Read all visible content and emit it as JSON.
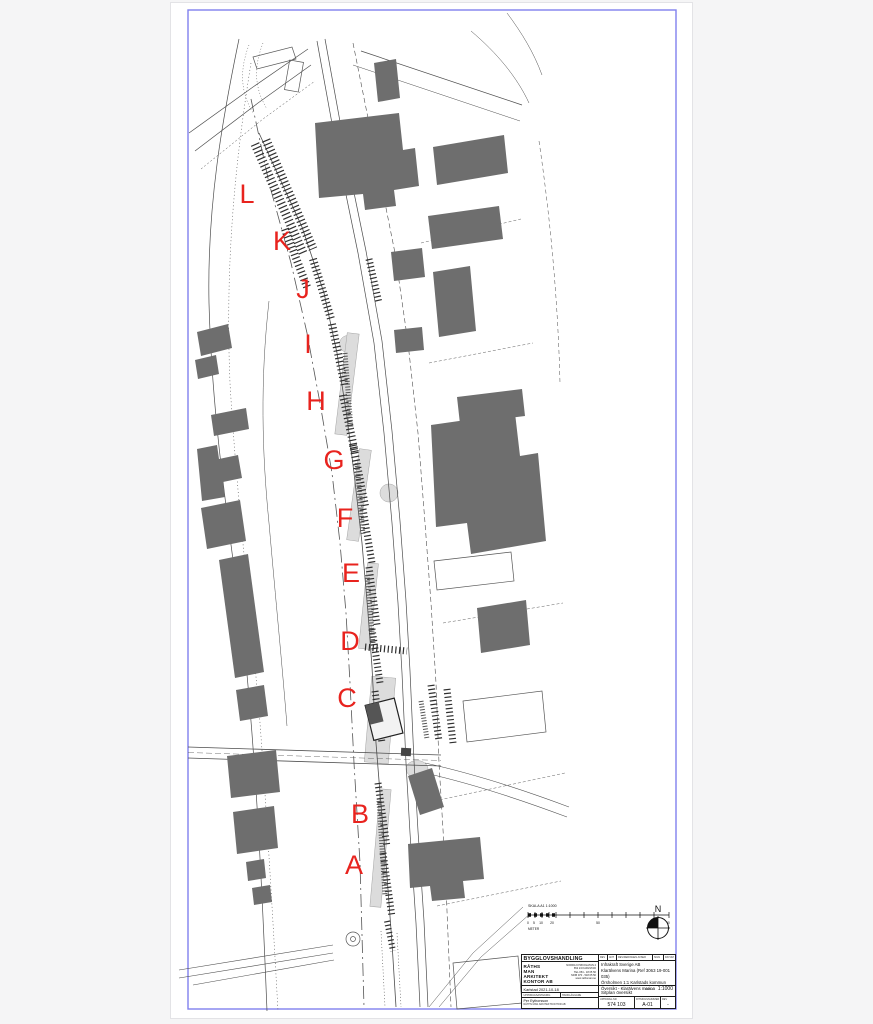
{
  "sheet": {
    "letters": [
      "A",
      "B",
      "C",
      "D",
      "E",
      "F",
      "G",
      "H",
      "I",
      "J",
      "K",
      "L"
    ],
    "marker_color": "#e8231e",
    "frame_color": "#8181ee",
    "building_color": "#6e6e6e",
    "scale_bar": {
      "title": "SKALA A1 1:1000",
      "tick_labels": [
        "0",
        "5",
        "10",
        "20",
        "50",
        "100"
      ],
      "unit": "METER"
    },
    "north_label": "N"
  },
  "title_block": {
    "doc_type": "BYGGLOVSHANDLING",
    "firm_name_lines": [
      "RÅTHS",
      "MAN",
      "ARKITEKT",
      "KONTOR AB"
    ],
    "firm_contact_lines": [
      "NORRA KYRKOGATAN 4",
      "652 24 KARLSTAD",
      "TEL 054 - 18 05 50",
      "MOB 070 - 518 05 50",
      "www.rathsman.se"
    ],
    "revision_headers": [
      "REV",
      "ANT",
      "REVIDERINGEN AVSER",
      "SIGN",
      "DATUM"
    ],
    "client": "Infrakraft Sverige AB",
    "project": "Klarälvens Marina  (Ref 3063 19-001 035)",
    "property": "Örsholmen 1:1  Karlstads kommun",
    "content": "Översikt - Klarälvens marina",
    "place_date": "Karlstad  2021-10-18",
    "role_headers": [
      "UPPDRAGSANSVARIG",
      "HANDLÄGGARE"
    ],
    "responsible": "Per Eythorsson",
    "responsible_sub": "RÅTHS MAN ARKITEKTKONTOR AB",
    "drawing_title": "Sitplan översikt",
    "scale_label": "SKALA",
    "scale_value": "1:1000",
    "number_header": "UPPDRAG.NR",
    "number": "574 103",
    "drawing_number_header": "RITNINGSNUMMER",
    "drawing_number": "A-01",
    "revision_header": "REV",
    "revision": "-"
  }
}
